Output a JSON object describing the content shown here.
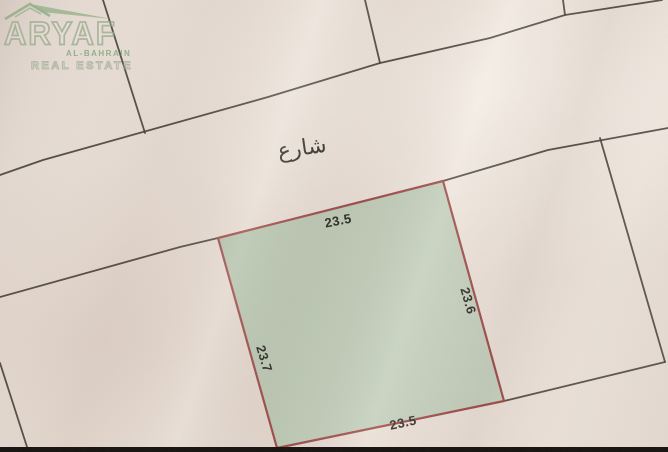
{
  "watermark": {
    "brand": "ARYAF",
    "sub_brand": "AL-BAHRAIN",
    "tagline": "REAL ESTATE"
  },
  "map": {
    "street_label": "شارع",
    "plot": {
      "top_length": "23.5",
      "right_length": "23.6",
      "left_length": "23.7",
      "bottom_length": "23.5"
    }
  },
  "colors": {
    "paper": "#e7dcd3",
    "plot_fill": "#bdcab6",
    "plot_border": "#9e4b49",
    "boundary_line": "#45403a",
    "logo_green": "#86a87c",
    "bottom_bar": "#151210",
    "label_ink": "#2b2a26"
  }
}
